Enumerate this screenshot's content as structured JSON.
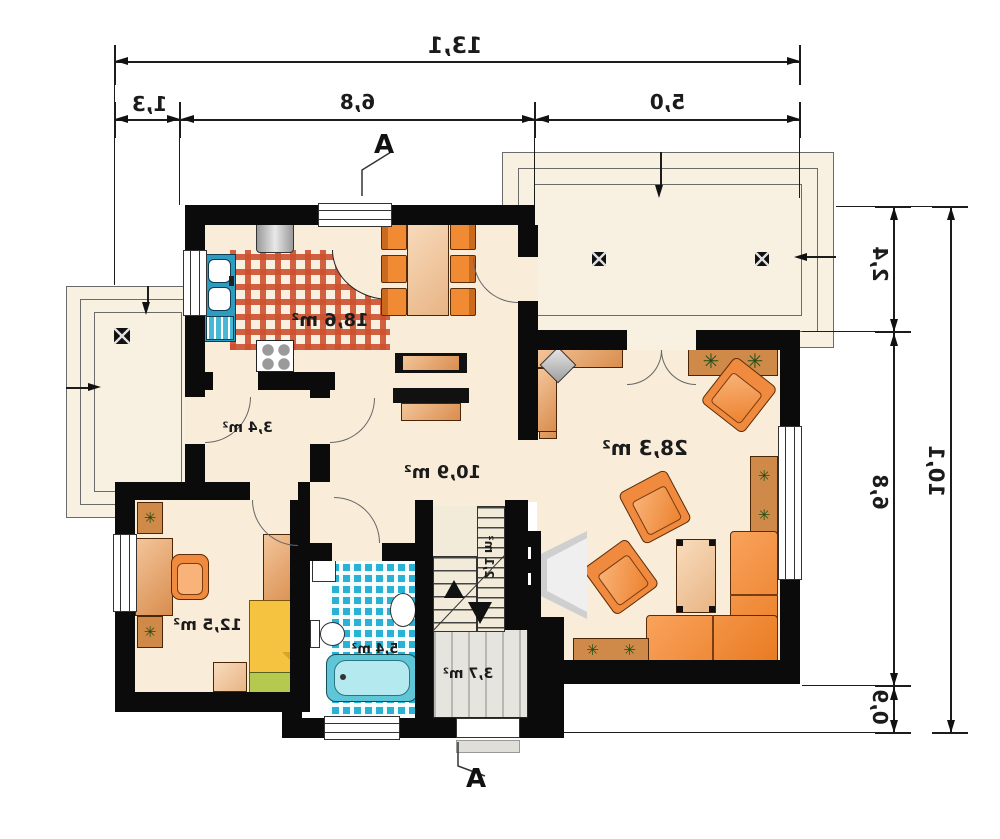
{
  "plan": {
    "section_marker_top": "A",
    "section_marker_bottom": "A"
  },
  "dimensions": {
    "top_total": "13,1",
    "top_segments": [
      "1,3",
      "6,8",
      "5,0"
    ],
    "right_total": "10,1",
    "right_segments": [
      "2,4",
      "6,8",
      "0,9"
    ]
  },
  "rooms": {
    "kitchen_dining": {
      "area": "18,6 m²"
    },
    "living_room": {
      "area": "28,3 m²"
    },
    "hall": {
      "area": "10,9 m²"
    },
    "corridor": {
      "area": "3,4 m²"
    },
    "bedroom": {
      "area": "12,5 m²"
    },
    "bathroom": {
      "area": "5,4 m²"
    },
    "stairs": {
      "area": "2,1 m²"
    },
    "vestibule": {
      "area": "3,7 m²"
    }
  },
  "icons": {
    "plant_glyph": "✳"
  },
  "colors": {
    "wall": "#0b0b0b",
    "floor": "#f9edda",
    "kitchen_tile_accent": "#cd502f",
    "bath_tile": "#29b2d3",
    "furniture_orange": "#ef8a3e"
  }
}
